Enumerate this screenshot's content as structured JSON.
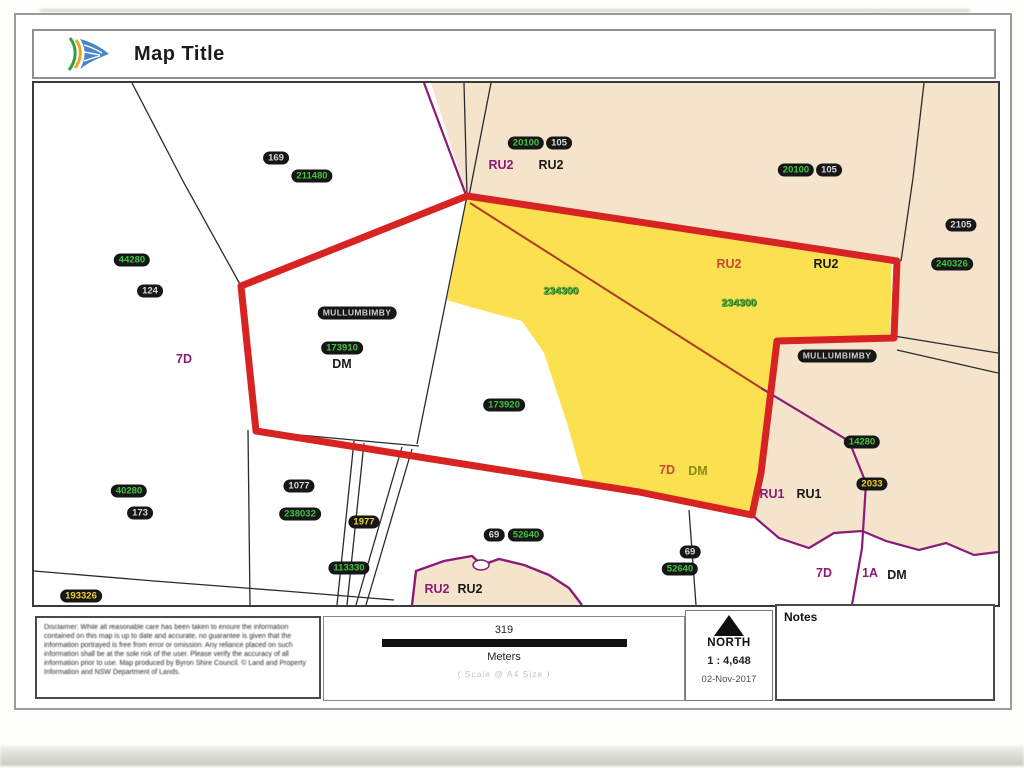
{
  "header": {
    "title": "Map Title",
    "logo_icon": "council-swoosh-logo"
  },
  "map": {
    "labels": [
      {
        "text": "169",
        "kind": "badge-gray",
        "x": 242,
        "y": 75
      },
      {
        "text": "211480",
        "kind": "badge-green",
        "x": 278,
        "y": 93
      },
      {
        "text": "20100",
        "kind": "badge-green",
        "x": 492,
        "y": 60
      },
      {
        "text": "105",
        "kind": "badge-gray",
        "x": 525,
        "y": 60
      },
      {
        "text": "RU2",
        "kind": "zone-purple",
        "x": 467,
        "y": 82
      },
      {
        "text": "RU2",
        "kind": "zone-black",
        "x": 517,
        "y": 82
      },
      {
        "text": "20100",
        "kind": "badge-green",
        "x": 762,
        "y": 87
      },
      {
        "text": "105",
        "kind": "badge-gray",
        "x": 795,
        "y": 87
      },
      {
        "text": "2105",
        "kind": "badge-gray",
        "x": 927,
        "y": 142
      },
      {
        "text": "240326",
        "kind": "badge-green",
        "x": 918,
        "y": 181
      },
      {
        "text": "44280",
        "kind": "badge-green",
        "x": 98,
        "y": 177
      },
      {
        "text": "124",
        "kind": "badge-gray",
        "x": 116,
        "y": 208
      },
      {
        "text": "7D",
        "kind": "zone-purple",
        "x": 150,
        "y": 276
      },
      {
        "text": "MULLUMBIMBY",
        "kind": "badge-town",
        "x": 323,
        "y": 230
      },
      {
        "text": "173910",
        "kind": "badge-green",
        "x": 308,
        "y": 265
      },
      {
        "text": "DM",
        "kind": "zone-black",
        "x": 308,
        "y": 281
      },
      {
        "text": "234300",
        "kind": "text-green",
        "x": 527,
        "y": 208
      },
      {
        "text": "RU2",
        "kind": "zone-red",
        "x": 695,
        "y": 181
      },
      {
        "text": "RU2",
        "kind": "zone-black",
        "x": 792,
        "y": 181
      },
      {
        "text": "234300",
        "kind": "text-green",
        "x": 705,
        "y": 220
      },
      {
        "text": "MULLUMBIMBY",
        "kind": "badge-town",
        "x": 803,
        "y": 273
      },
      {
        "text": "173920",
        "kind": "badge-green",
        "x": 470,
        "y": 322
      },
      {
        "text": "7D",
        "kind": "zone-red",
        "x": 633,
        "y": 387
      },
      {
        "text": "DM",
        "kind": "zone-olive",
        "x": 664,
        "y": 388
      },
      {
        "text": "14280",
        "kind": "badge-green",
        "x": 828,
        "y": 359
      },
      {
        "text": "2033",
        "kind": "badge-yellow",
        "x": 838,
        "y": 401
      },
      {
        "text": "RU1",
        "kind": "zone-purple",
        "x": 738,
        "y": 411
      },
      {
        "text": "RU1",
        "kind": "zone-black",
        "x": 775,
        "y": 411
      },
      {
        "text": "40280",
        "kind": "badge-green",
        "x": 95,
        "y": 408
      },
      {
        "text": "173",
        "kind": "badge-gray",
        "x": 106,
        "y": 430
      },
      {
        "text": "1077",
        "kind": "badge-gray",
        "x": 265,
        "y": 403
      },
      {
        "text": "238032",
        "kind": "badge-green",
        "x": 266,
        "y": 431
      },
      {
        "text": "1977",
        "kind": "badge-yellow",
        "x": 330,
        "y": 439
      },
      {
        "text": "113330",
        "kind": "badge-green",
        "x": 315,
        "y": 485
      },
      {
        "text": "69",
        "kind": "badge-gray",
        "x": 460,
        "y": 452
      },
      {
        "text": "52640",
        "kind": "badge-green",
        "x": 492,
        "y": 452
      },
      {
        "text": "RU2",
        "kind": "zone-purple",
        "x": 403,
        "y": 506
      },
      {
        "text": "RU2",
        "kind": "zone-black",
        "x": 436,
        "y": 506
      },
      {
        "text": "69",
        "kind": "badge-gray",
        "x": 656,
        "y": 469
      },
      {
        "text": "52640",
        "kind": "badge-green",
        "x": 646,
        "y": 486
      },
      {
        "text": "193326",
        "kind": "badge-yellow",
        "x": 47,
        "y": 513
      },
      {
        "text": "7D",
        "kind": "zone-purple",
        "x": 790,
        "y": 490
      },
      {
        "text": "1A",
        "kind": "zone-purple",
        "x": 836,
        "y": 490
      },
      {
        "text": "DM",
        "kind": "zone-black",
        "x": 863,
        "y": 492
      }
    ]
  },
  "footer": {
    "disclaimer": "Disclaimer: While all reasonable care has been taken to ensure the information contained on this map is up to date and accurate, no guarantee is given that the information portrayed is free from error or omission. Any reliance placed on such information shall be at the sole risk of the user. Please verify the accuracy of all information prior to use. Map produced by Byron Shire Council. © Land and Property Information and NSW Department of Lands.",
    "scale": {
      "distance": "319",
      "units": "Meters",
      "note": "( Scale @ A4 Size )",
      "ratio": "1 :  4,648",
      "date": "02-Nov-2017"
    },
    "north_label": "NORTH",
    "notes_label": "Notes"
  },
  "colors": {
    "selection_red": "#d82323",
    "zone_beige": "#f5e4cc",
    "highlight_yellow": "#fbe14f",
    "zone_purple": "#8b1a7a",
    "badge_green": "#3fc43f",
    "badge_yellow": "#f0d030"
  }
}
